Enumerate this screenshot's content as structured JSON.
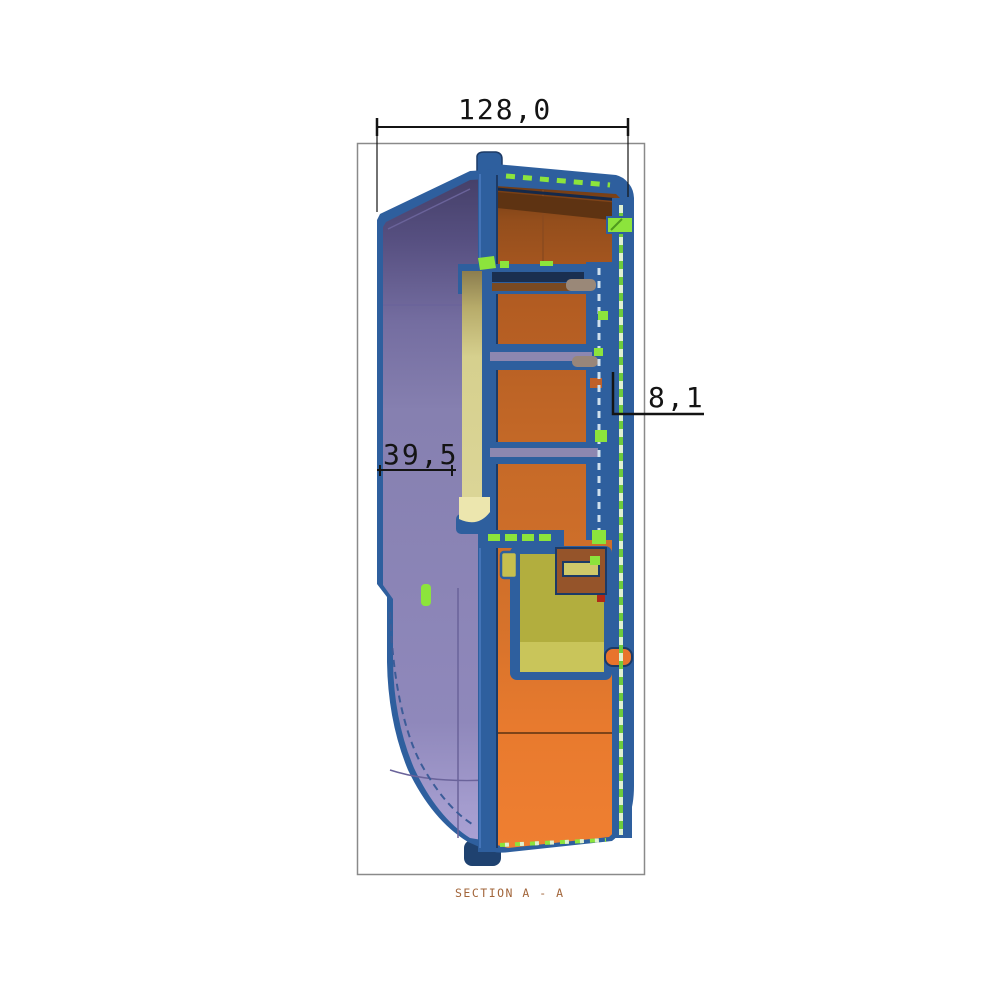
{
  "drawing": {
    "view_label": "SECTION A - A",
    "dimensions": {
      "overall_width": "128,0",
      "wall_thickness": "8,1",
      "shell_depth": "39,5"
    },
    "colors": {
      "outline_blue": "#2e5f9e",
      "navy_dark": "#1c3a66",
      "tab_navy": "#1f4270",
      "shell_purple": "#8680b0",
      "shell_purple_dark": "#433e66",
      "shell_lavender": "#aaa2d6",
      "section_orange": "#d4722a",
      "section_orange_dark": "#6e3a14",
      "section_orange_bright": "#ef7f31",
      "part_yellow": "#d6d08e",
      "part_olive": "#b2ae3e",
      "part_olive_light": "#c9c55a",
      "highlight_green": "#8ce43c",
      "dash_mint": "#dff0d0",
      "boss_gray": "#9a8878",
      "stripe_gray": "#8d87b0",
      "dim_line": "#141414",
      "section_label_color": "#a2653a",
      "border_gray": "#8a8a8a"
    }
  }
}
